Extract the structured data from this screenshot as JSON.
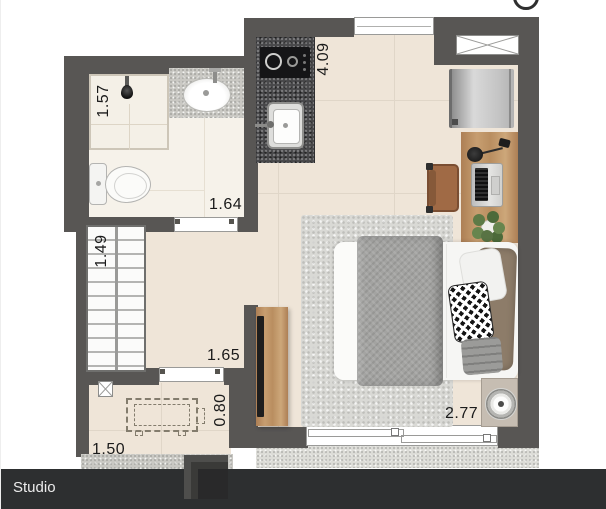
{
  "title_bar": {
    "label": "Studio"
  },
  "labels": {
    "shower_width": "1.57",
    "bathroom_width": "1.64",
    "room_length": "4.09",
    "closet_width": "1.49",
    "hall_width": "1.65",
    "entry_table_depth": "0.80",
    "entry_width": "1.50",
    "bedroom_width": "2.77"
  },
  "colors": {
    "wall": "#585654",
    "floor": "#efe5d8",
    "bathroom_floor": "#f6f2ea",
    "counter_granite": "#48484a",
    "wood": "#bf9468",
    "bottom_bar": "#2d2f30"
  }
}
